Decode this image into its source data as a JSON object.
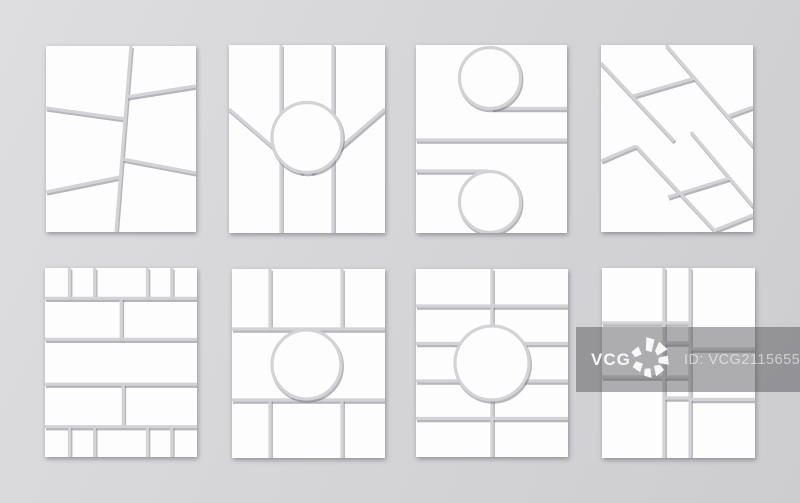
{
  "watermark": {
    "brand": "VCG",
    "id_text": "ID: VCG211565527797"
  },
  "colors": {
    "background": "#d6d6d8",
    "panel": "#fdfdfe",
    "divider_gap": "#d3d3d6",
    "divider_shadow": "rgba(110,110,118,0.5)",
    "watermark_band": "rgba(75,75,80,0.45)",
    "watermark_brand_text": "#ffffff",
    "watermark_id_text": "rgba(255,255,255,0.55)"
  },
  "board": {
    "rows": 2,
    "columns": 4,
    "template_count": 8,
    "templates": [
      {
        "id": "template-1",
        "description": "slanted two-column frame with six tilted cells"
      },
      {
        "id": "template-2",
        "description": "three vertical columns, V diagonals meeting a center circle frame"
      },
      {
        "id": "template-3",
        "description": "two horizontal halves, circle at top center and bottom center"
      },
      {
        "id": "template-4",
        "description": "diagonal lattice of parallelogram cells"
      },
      {
        "id": "template-5",
        "description": "five banded rows split 5-2-1-2-5"
      },
      {
        "id": "template-6",
        "description": "three-by-three grid with circular center cell"
      },
      {
        "id": "template-7",
        "description": "five rows by two columns with center circle overlay"
      },
      {
        "id": "template-8",
        "description": "three-column mondrian grid with narrow middle column"
      }
    ]
  }
}
